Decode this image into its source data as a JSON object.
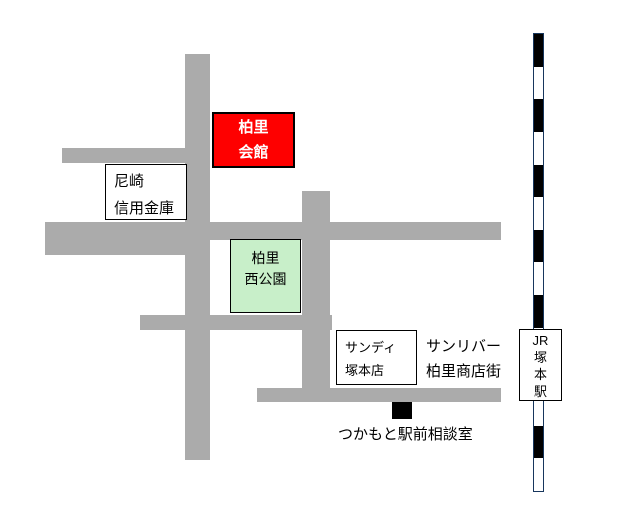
{
  "colors": {
    "road": "#ababab",
    "kaikan_fill": "#fe0000",
    "kaikan_text": "#ffffff",
    "park_fill": "#c8efc9",
    "railway_dark": "#000000",
    "railway_light": "#ffffff",
    "marker": "#000000"
  },
  "landmarks": {
    "kaikan": {
      "lines": [
        "柏里",
        "会館"
      ]
    },
    "bank": {
      "lines": [
        "尼崎",
        "信用金庫"
      ]
    },
    "park": {
      "lines": [
        "柏里",
        "西公園"
      ]
    },
    "sandy": {
      "lines": [
        "サンディ",
        "塚本店"
      ]
    },
    "sunriver": {
      "lines": [
        "サンリバー",
        "柏里商店街"
      ]
    },
    "station": {
      "lines": [
        "JR",
        "塚",
        "本",
        "駅"
      ]
    },
    "office": {
      "label": "つかもと駅前相談室"
    }
  },
  "railway": {
    "segment_count": 14
  }
}
